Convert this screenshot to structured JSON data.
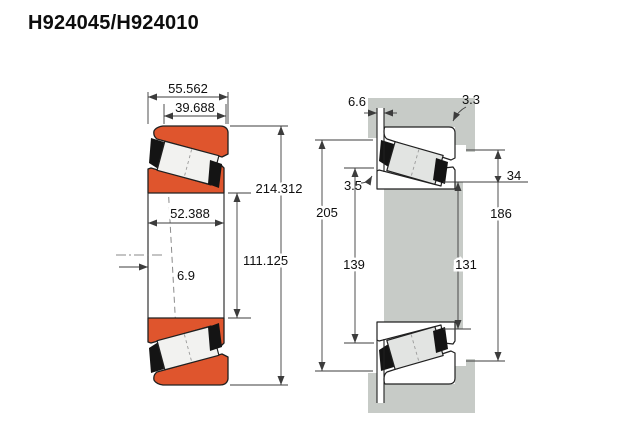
{
  "title": "H924045/H924010",
  "colors": {
    "ring": "#df552d",
    "steel": "#c7cbc7",
    "roller": "#e2e4e2",
    "cage": "#141414",
    "outline": "#202020",
    "dim": "#3c3c3c"
  },
  "left_diagram": {
    "dims": {
      "overall_width": "55.562",
      "cup_width": "39.688",
      "outer_diameter": "214.312",
      "cone_width": "52.388",
      "bore_diameter": "111.125",
      "load_center_offset": "6.9"
    }
  },
  "right_diagram": {
    "dims": {
      "cone_overhang": "6.6",
      "cup_corner_radius": "3.3",
      "cone_corner_radius": "3.5",
      "shoulder_step": "34",
      "housing_bore_diameter": "205",
      "shaft_abutment_diameter": "139",
      "housing_abutment_diameter": "186",
      "shaft_shoulder_diameter": "131"
    }
  }
}
